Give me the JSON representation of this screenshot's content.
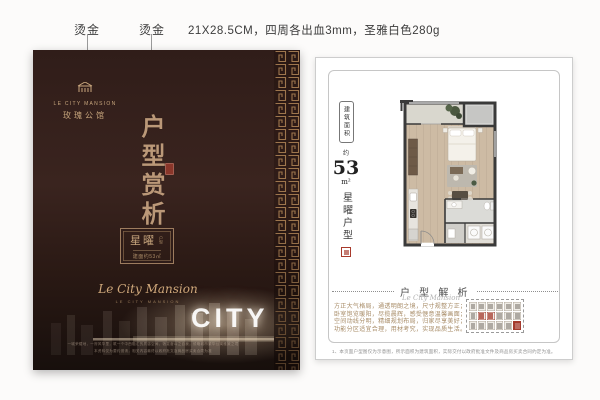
{
  "annotations": {
    "foil_label_1": "烫金",
    "foil_label_2": "烫金",
    "print_spec": "21X28.5CM，四周各出血3mm，圣雅白色280g"
  },
  "cover": {
    "brand_en": "LE CITY MANSION",
    "brand_cn": "玫瑰公馆",
    "title_vertical": "户型赏析",
    "unit_card": {
      "name": "星曜",
      "name_suffix": "户型",
      "area_line": "建面约53㎡"
    },
    "script_signature": "Le City Mansion",
    "signature_caps": "LE CITY MANSION",
    "city_watermark": "CITY",
    "disclaimer_line1": "一城荣耀地，一府风华里，筑一个中西融汇的质感空间，犒赏奋斗之自我，领略城市繁华公寓雅致之境",
    "disclaimer_line2": "本资料仅为要约邀请，相关内容最终以政府批文及商品房买卖合同为准"
  },
  "plan_page": {
    "area_box_label": "建筑面积",
    "area_approx": "约",
    "area_value": "53",
    "area_unit": "m²",
    "unit_name": "星曜户型",
    "section_title": "户 型 解 析",
    "section_script": "Le City Mansion",
    "copy_line1": "方正大气格局，通透明朗之境，尺寸规整方正；",
    "copy_line2": "卧室饱览暖阳，尽揽晨辉，感受惬意温馨画面；",
    "copy_line3": "空间动线分明，精细规划布局，归家尽享美好；",
    "copy_line4": "功能分区适宜合理，用材考究，实现品质生活。",
    "note": "1、本页面户型图仅为示意图，所示面积为建筑面积，实际交付以政府批准文件及商品房买卖合同约定为准。"
  },
  "colors": {
    "cover_background": "#2f1c18",
    "foil_gold": "#bb9878",
    "lattice_gold": "#a87e52",
    "seal_red": "#9e3b30",
    "plan_wall": "#3a3a3a",
    "plan_floor": "#cdbba4"
  }
}
